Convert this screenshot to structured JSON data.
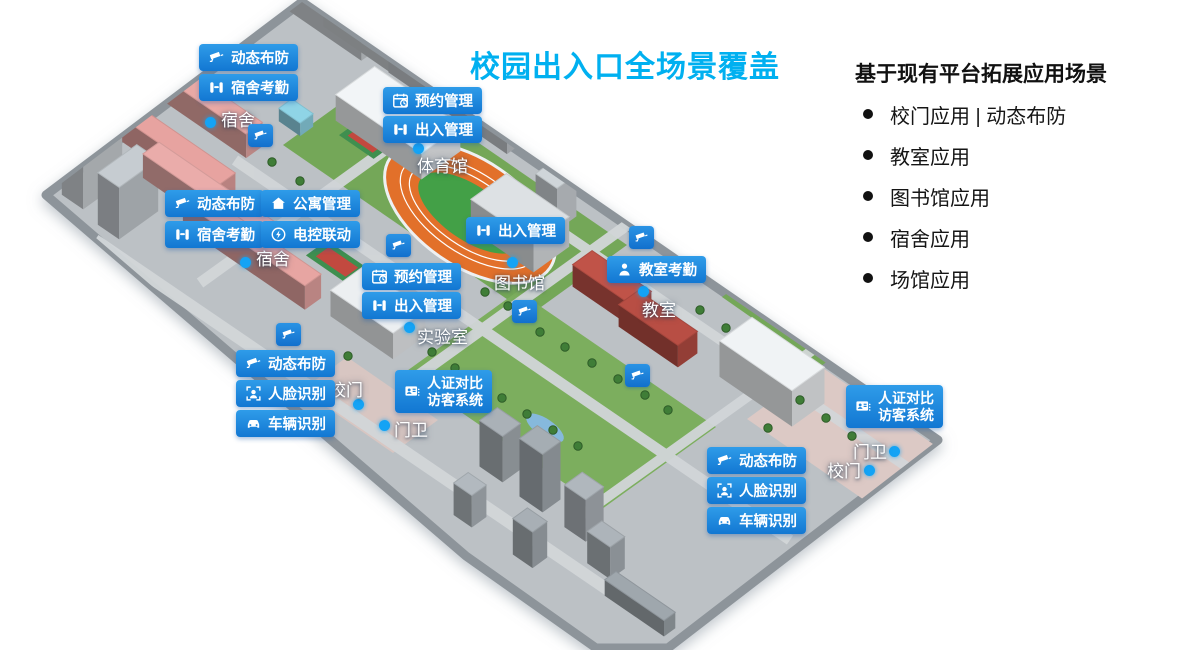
{
  "title": "校园出入口全场景覆盖",
  "panel": {
    "heading": "基于现有平台拓展应用场景",
    "items": [
      "校门应用 | 动态布防",
      "教室应用",
      "图书馆应用",
      "宿舍应用",
      "场馆应用"
    ]
  },
  "colors": {
    "accent": "#1e86dc",
    "title": "#00b0f0",
    "dot": "#14a3f5"
  },
  "map": {
    "badges": [
      {
        "name": "badge-dynamic-defense-dorm-north",
        "icon": "cctv-camera-icon",
        "label": "动态布防",
        "x": 199,
        "y": 44
      },
      {
        "name": "badge-dorm-attendance-north",
        "icon": "turnstile-icon",
        "label": "宿舍考勤",
        "x": 199,
        "y": 74
      },
      {
        "name": "badge-reservation-gym",
        "icon": "calendar-clock-icon",
        "label": "预约管理",
        "x": 383,
        "y": 87
      },
      {
        "name": "badge-access-gym",
        "icon": "turnstile-icon",
        "label": "出入管理",
        "x": 383,
        "y": 116
      },
      {
        "name": "badge-dynamic-defense-dorm-west",
        "icon": "cctv-camera-icon",
        "label": "动态布防",
        "x": 165,
        "y": 190
      },
      {
        "name": "badge-apartment-management",
        "icon": "home-icon",
        "label": "公寓管理",
        "x": 261,
        "y": 190
      },
      {
        "name": "badge-dorm-attendance-west",
        "icon": "turnstile-icon",
        "label": "宿舍考勤",
        "x": 165,
        "y": 221
      },
      {
        "name": "badge-electric-control-linkage",
        "icon": "power-icon",
        "label": "电控联动",
        "x": 261,
        "y": 221
      },
      {
        "name": "badge-reservation-lab",
        "icon": "calendar-clock-icon",
        "label": "预约管理",
        "x": 362,
        "y": 263
      },
      {
        "name": "badge-access-lab",
        "icon": "turnstile-icon",
        "label": "出入管理",
        "x": 362,
        "y": 292
      },
      {
        "name": "badge-access-library",
        "icon": "turnstile-icon",
        "label": "出入管理",
        "x": 466,
        "y": 217
      },
      {
        "name": "badge-classroom-attendance",
        "icon": "person-icon",
        "label": "教室考勤",
        "x": 607,
        "y": 256
      },
      {
        "name": "badge-dynamic-defense-gate-west",
        "icon": "cctv-camera-icon",
        "label": "动态布防",
        "x": 236,
        "y": 350
      },
      {
        "name": "badge-face-recognition-west",
        "icon": "face-icon",
        "label": "人脸识别",
        "x": 236,
        "y": 380
      },
      {
        "name": "badge-vehicle-recognition-west",
        "icon": "car-icon",
        "label": "车辆识别",
        "x": 236,
        "y": 410
      },
      {
        "name": "badge-visitor-system-west",
        "icon": "id-card-icon",
        "lines": [
          "人证对比",
          "访客系统"
        ],
        "x": 395,
        "y": 370
      },
      {
        "name": "badge-visitor-system-east",
        "icon": "id-card-icon",
        "lines": [
          "人证对比",
          "访客系统"
        ],
        "x": 846,
        "y": 385
      },
      {
        "name": "badge-dynamic-defense-gate-east",
        "icon": "cctv-camera-icon",
        "label": "动态布防",
        "x": 707,
        "y": 447
      },
      {
        "name": "badge-face-recognition-east",
        "icon": "face-icon",
        "label": "人脸识别",
        "x": 707,
        "y": 477
      },
      {
        "name": "badge-vehicle-recognition-east",
        "icon": "car-icon",
        "label": "车辆识别",
        "x": 707,
        "y": 507
      }
    ],
    "labels": [
      {
        "name": "label-dorm-north",
        "text": "宿舍",
        "x": 221,
        "y": 106
      },
      {
        "name": "label-gymnasium",
        "text": "体育馆",
        "x": 417,
        "y": 152
      },
      {
        "name": "label-dorm-west",
        "text": "宿舍",
        "x": 256,
        "y": 245
      },
      {
        "name": "label-laboratory",
        "text": "实验室",
        "x": 417,
        "y": 323
      },
      {
        "name": "label-library",
        "text": "图书馆",
        "x": 494,
        "y": 269
      },
      {
        "name": "label-classroom",
        "text": "教室",
        "x": 642,
        "y": 296
      },
      {
        "name": "label-school-gate-west",
        "text": "校门",
        "x": 329,
        "y": 376
      },
      {
        "name": "label-guard-west",
        "text": "门卫",
        "x": 394,
        "y": 416
      },
      {
        "name": "label-guard-east",
        "text": "门卫",
        "x": 853,
        "y": 438
      },
      {
        "name": "label-school-gate-east",
        "text": "校门",
        "x": 827,
        "y": 457
      }
    ],
    "dots": [
      {
        "x": 205,
        "y": 117
      },
      {
        "x": 413,
        "y": 143
      },
      {
        "x": 240,
        "y": 257
      },
      {
        "x": 404,
        "y": 322
      },
      {
        "x": 507,
        "y": 257
      },
      {
        "x": 638,
        "y": 286
      },
      {
        "x": 353,
        "y": 399
      },
      {
        "x": 379,
        "y": 420
      },
      {
        "x": 889,
        "y": 446
      },
      {
        "x": 864,
        "y": 465
      }
    ],
    "cameras": [
      {
        "x": 248,
        "y": 124
      },
      {
        "x": 386,
        "y": 234
      },
      {
        "x": 276,
        "y": 323
      },
      {
        "x": 512,
        "y": 300
      },
      {
        "x": 629,
        "y": 226
      },
      {
        "x": 625,
        "y": 364
      }
    ]
  }
}
